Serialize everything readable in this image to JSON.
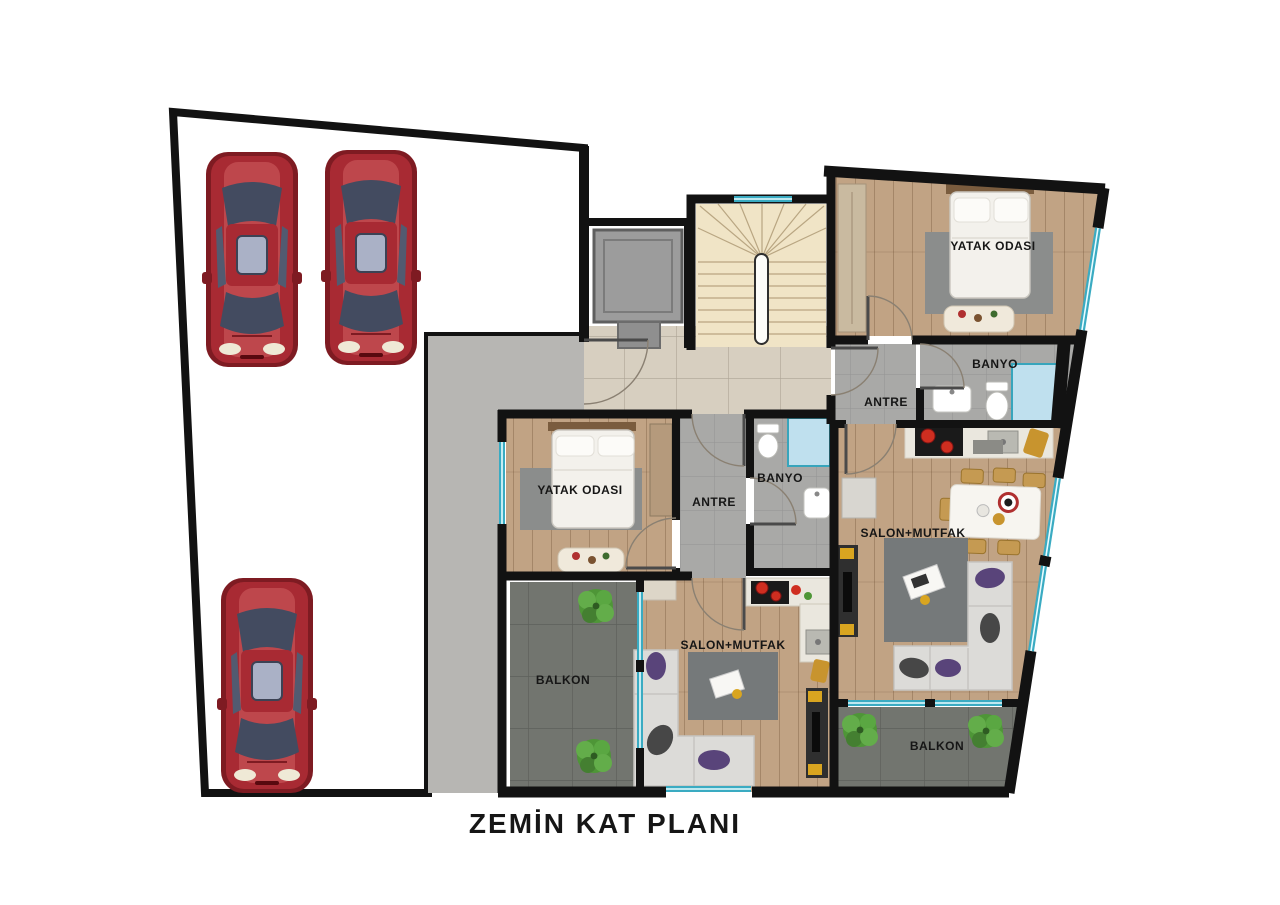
{
  "title": "ZEMİN KAT PLANI",
  "apartments": {
    "right": {
      "bedroom": "YATAK ODASI",
      "bathroom": "BANYO",
      "hallway": "ANTRE",
      "living_kitchen": "SALON+MUTFAK",
      "balcony": "BALKON"
    },
    "middle": {
      "bedroom": "YATAK ODASI",
      "bathroom": "BANYO",
      "hallway": "ANTRE",
      "living_kitchen": "SALON+MUTFAK",
      "balcony": "BALKON"
    }
  },
  "parking": {
    "car_count": 3
  },
  "colors": {
    "wall": "#121212",
    "asphalt": "#696969",
    "walkway": "#b7b6b3",
    "corridor_tile": "#d7cfc0",
    "stairs": "#f0e4c6",
    "wood_floor": "#c1a384",
    "gray_tile": "#a9a9a7",
    "balcony_tile": "#72756f",
    "rug": "#8b8d8c",
    "rug_dark": "#75797a",
    "window_teal": "#3aabc2",
    "window_core": "#eafcff",
    "shower_blue": "#bfe0ee",
    "marble": "#eae7de",
    "car_red": "#a82a33",
    "car_dark": "#7e1b22",
    "car_window": "#434b60",
    "plant_green": "#4e9637",
    "sofa": "#dcdbd8",
    "cushion_purple": "#59447a",
    "throw_gray": "#474747",
    "bed_white": "#f3f1ec",
    "headboard_wood": "#7a5c3e",
    "elevator_gray": "#9c9c9c",
    "accent_yellow": "#d9a520",
    "stove_black": "#1a1a1a",
    "text_color": "#161616"
  }
}
